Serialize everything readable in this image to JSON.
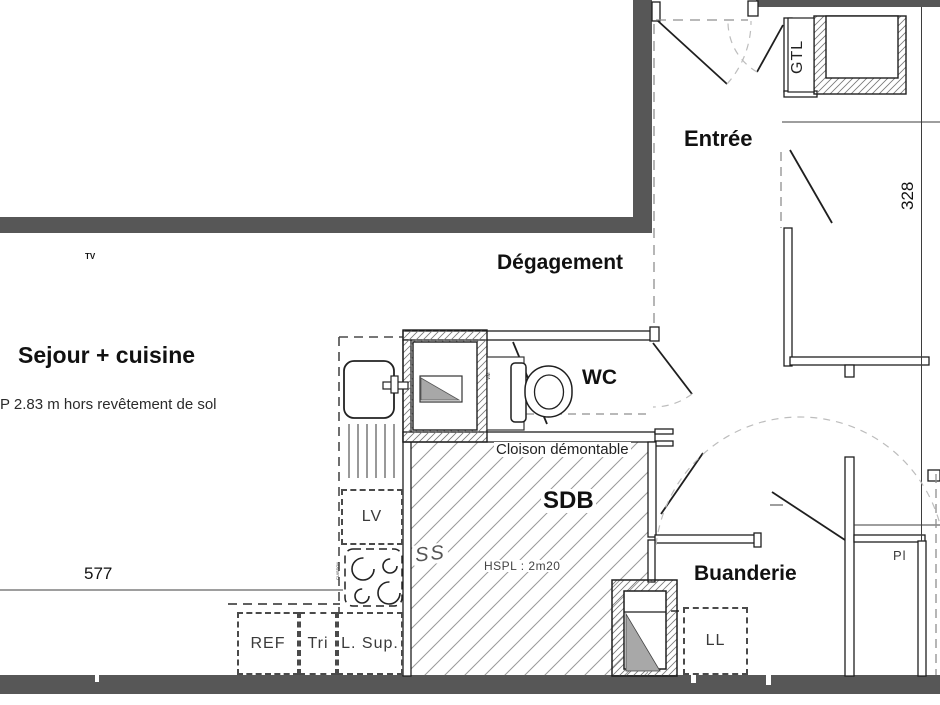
{
  "rooms": {
    "sejour": "Sejour + cuisine",
    "degagement": "Dégagement",
    "entree": "Entrée",
    "wc": "WC",
    "sdb": "SDB",
    "buanderie": "Buanderie"
  },
  "annotations": {
    "ceiling_note": "P 2.83 m hors revêtement de sol",
    "cloison": "Cloison démontable",
    "hspl": "HSPL : 2m20",
    "ss": "SS",
    "gtl": "GTL",
    "pl": "Pl",
    "tv": "TV",
    "vm": "VM",
    "cuisson": "CUISSON"
  },
  "appliances": {
    "ref": "REF",
    "tri": "Tri",
    "l_sup": "L. Sup.",
    "lv": "LV",
    "ll": "LL"
  },
  "dimensions": {
    "horizontal": "577",
    "vertical": "328"
  },
  "colors": {
    "wall": "#575757",
    "line": "#1f1f1f",
    "hatch_light": "#9a9a9a",
    "hatch_dense": "#777777",
    "gray_fill": "#a8a8a8"
  }
}
